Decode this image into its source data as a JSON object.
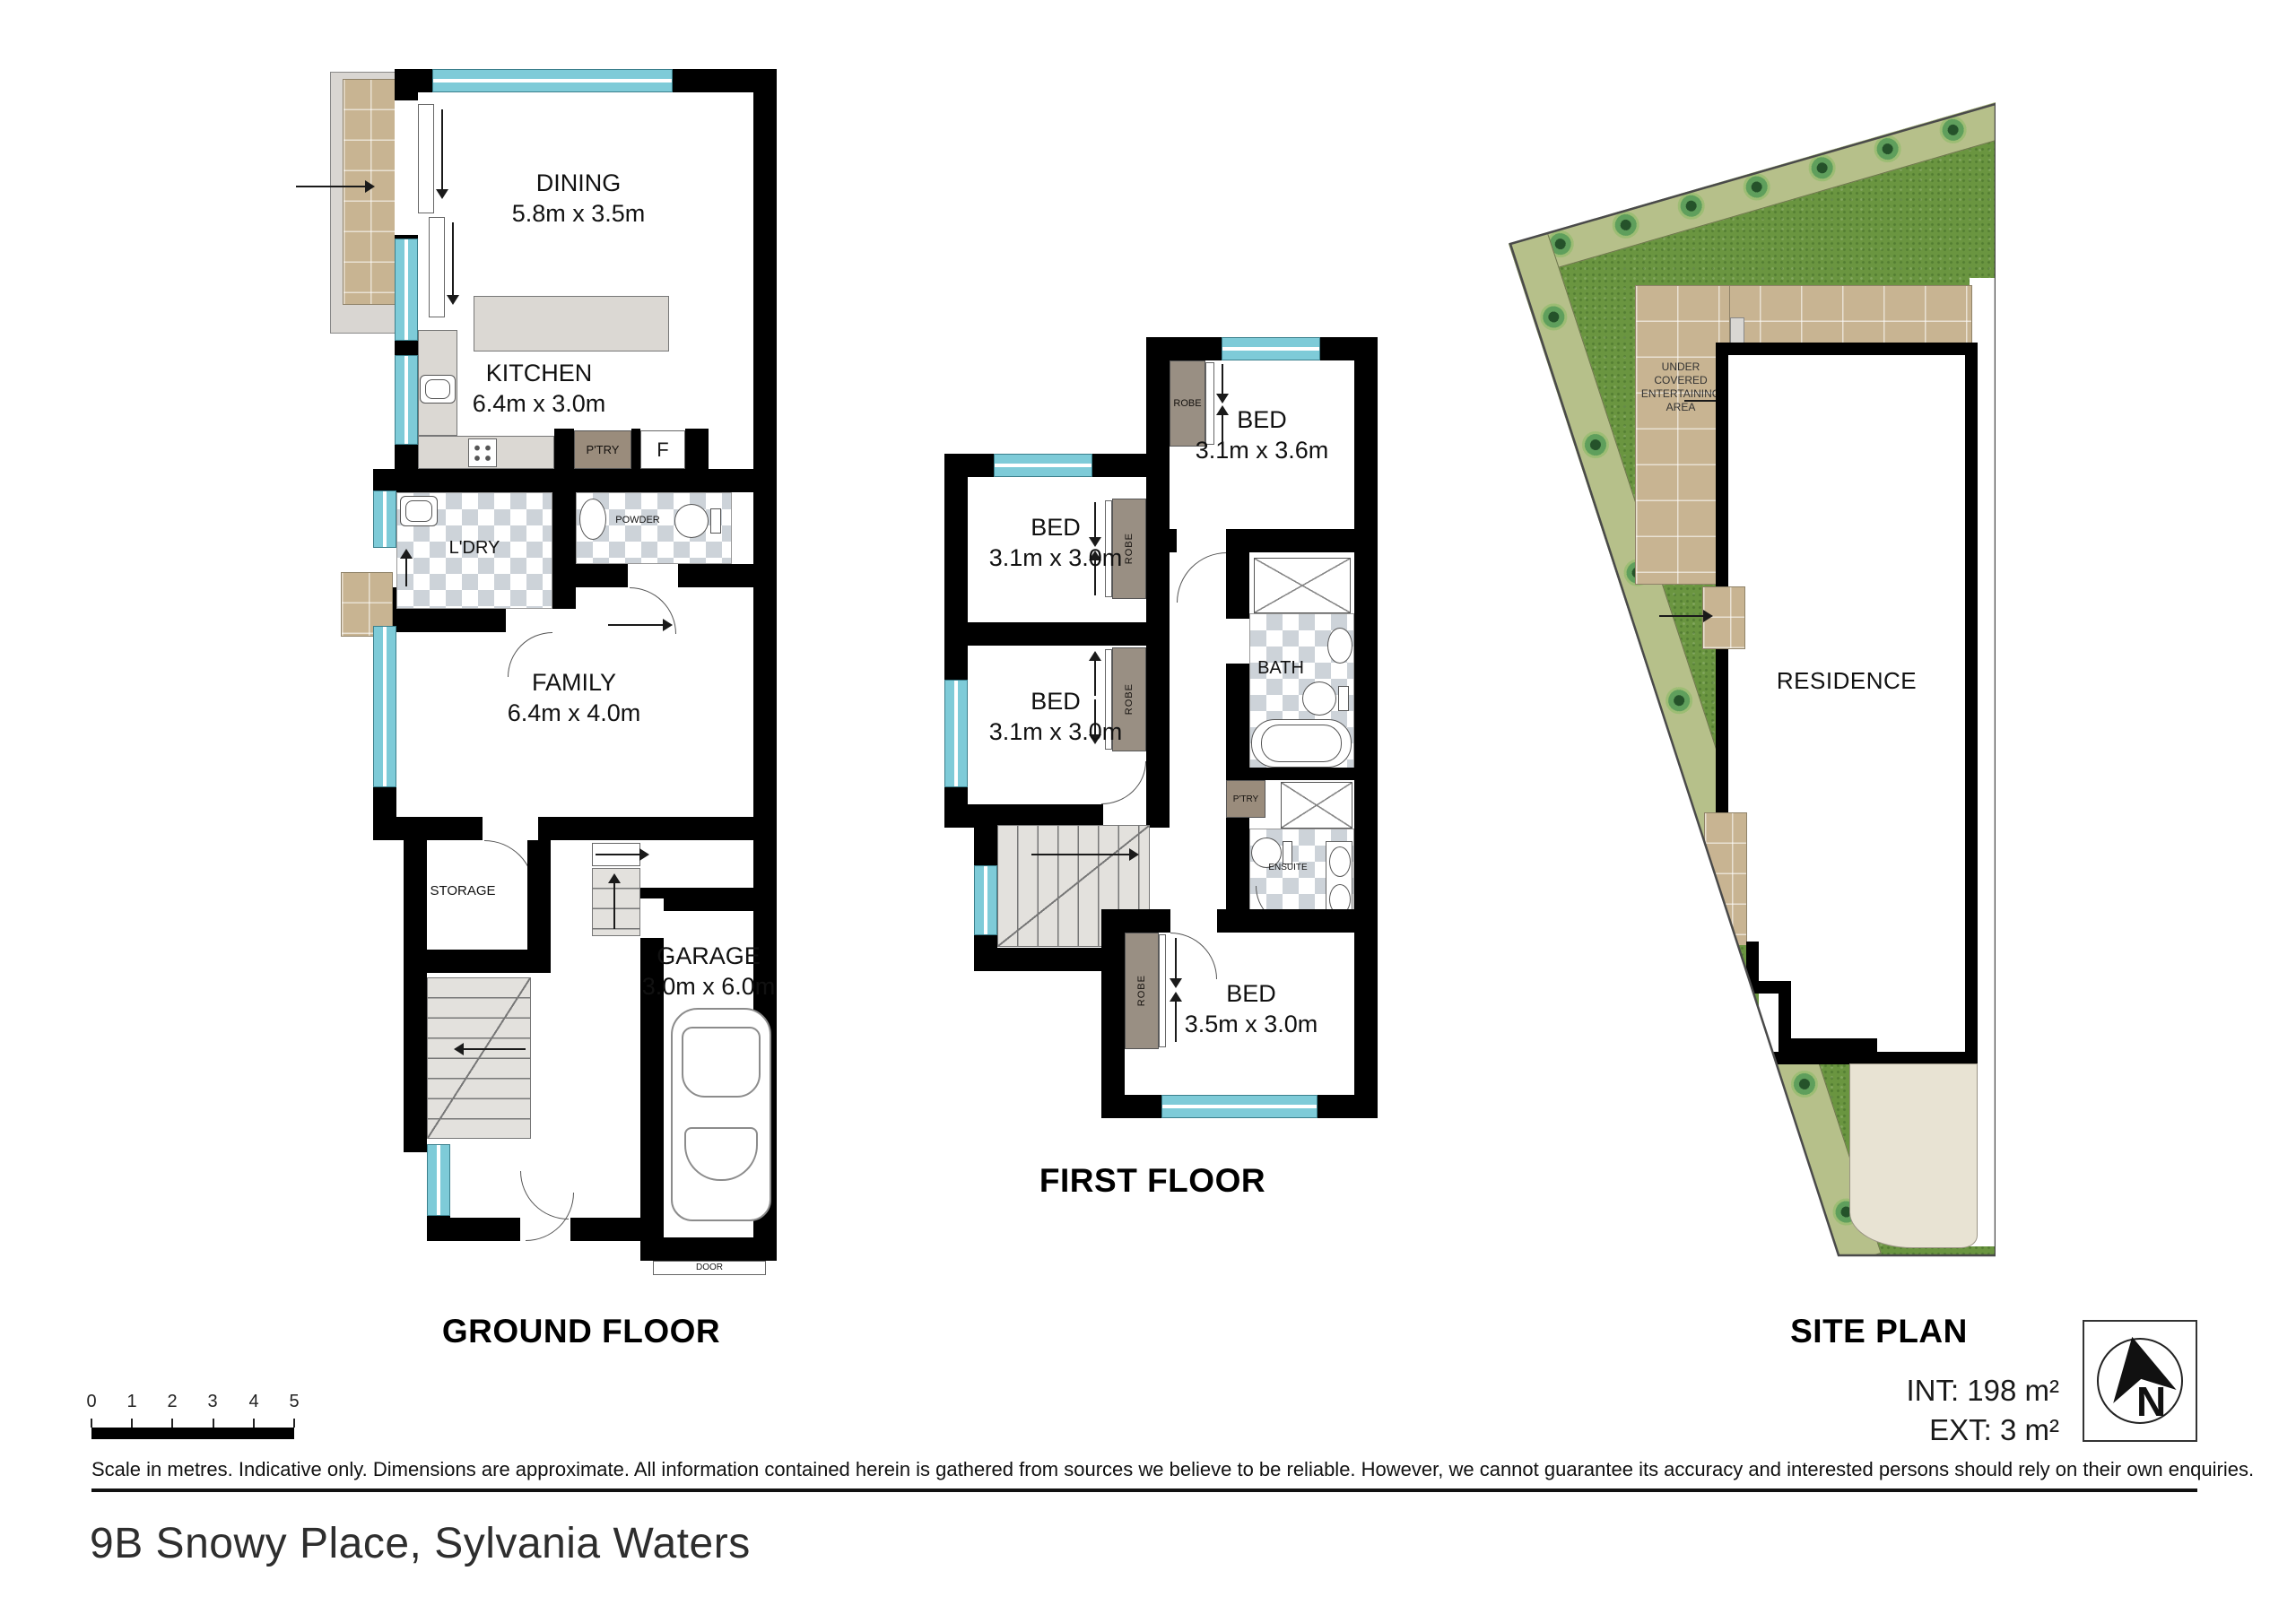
{
  "address": "9B Snowy Place, Sylvania Waters",
  "ground_floor": {
    "title": "GROUND FLOOR",
    "dining": {
      "name": "DINING",
      "dims": "5.8m x 3.5m"
    },
    "kitchen": {
      "name": "KITCHEN",
      "dims": "6.4m x 3.0m"
    },
    "family": {
      "name": "FAMILY",
      "dims": "6.4m x 4.0m"
    },
    "garage": {
      "name": "GARAGE",
      "dims": "3.0m x 6.0m"
    },
    "pantry": "P'TRY",
    "fridge": "F",
    "powder": "POWDER",
    "laundry": "L'DRY",
    "storage": "STORAGE",
    "door": "DOOR"
  },
  "first_floor": {
    "title": "FIRST FLOOR",
    "bed1": {
      "name": "BED",
      "dims": "3.1m x 3.6m"
    },
    "bed2": {
      "name": "BED",
      "dims": "3.1m x 3.0m"
    },
    "bed3": {
      "name": "BED",
      "dims": "3.1m x 3.0m"
    },
    "bed4": {
      "name": "BED",
      "dims": "3.5m x 3.0m"
    },
    "bath": "BATH",
    "ensuite": "ENSUITE",
    "pantry": "P'TRY",
    "robe": "ROBE"
  },
  "site_plan": {
    "title": "SITE PLAN",
    "residence": "RESIDENCE",
    "entertaining": "UNDER COVERED ENTERTAINING AREA",
    "int_area": "INT: 198 m²",
    "ext_area": "EXT: 3 m²",
    "compass_letter": "N"
  },
  "scale": {
    "ticks": [
      "0",
      "1",
      "2",
      "3",
      "4",
      "5"
    ]
  },
  "disclaimer": "Scale in metres. Indicative only. Dimensions are approximate. All information contained herein is gathered from sources we believe to be reliable. However, we cannot guarantee its accuracy and interested persons should rely on their own enquiries.",
  "colors": {
    "wall": "#000000",
    "window": "#7ecbd8",
    "robe": "#998f83",
    "tile": "#cdd3d9",
    "paver": "#c8b492",
    "lawn": "#6a9540",
    "garden_border": "#b6c08a",
    "driveway": "#e8e3d3"
  }
}
